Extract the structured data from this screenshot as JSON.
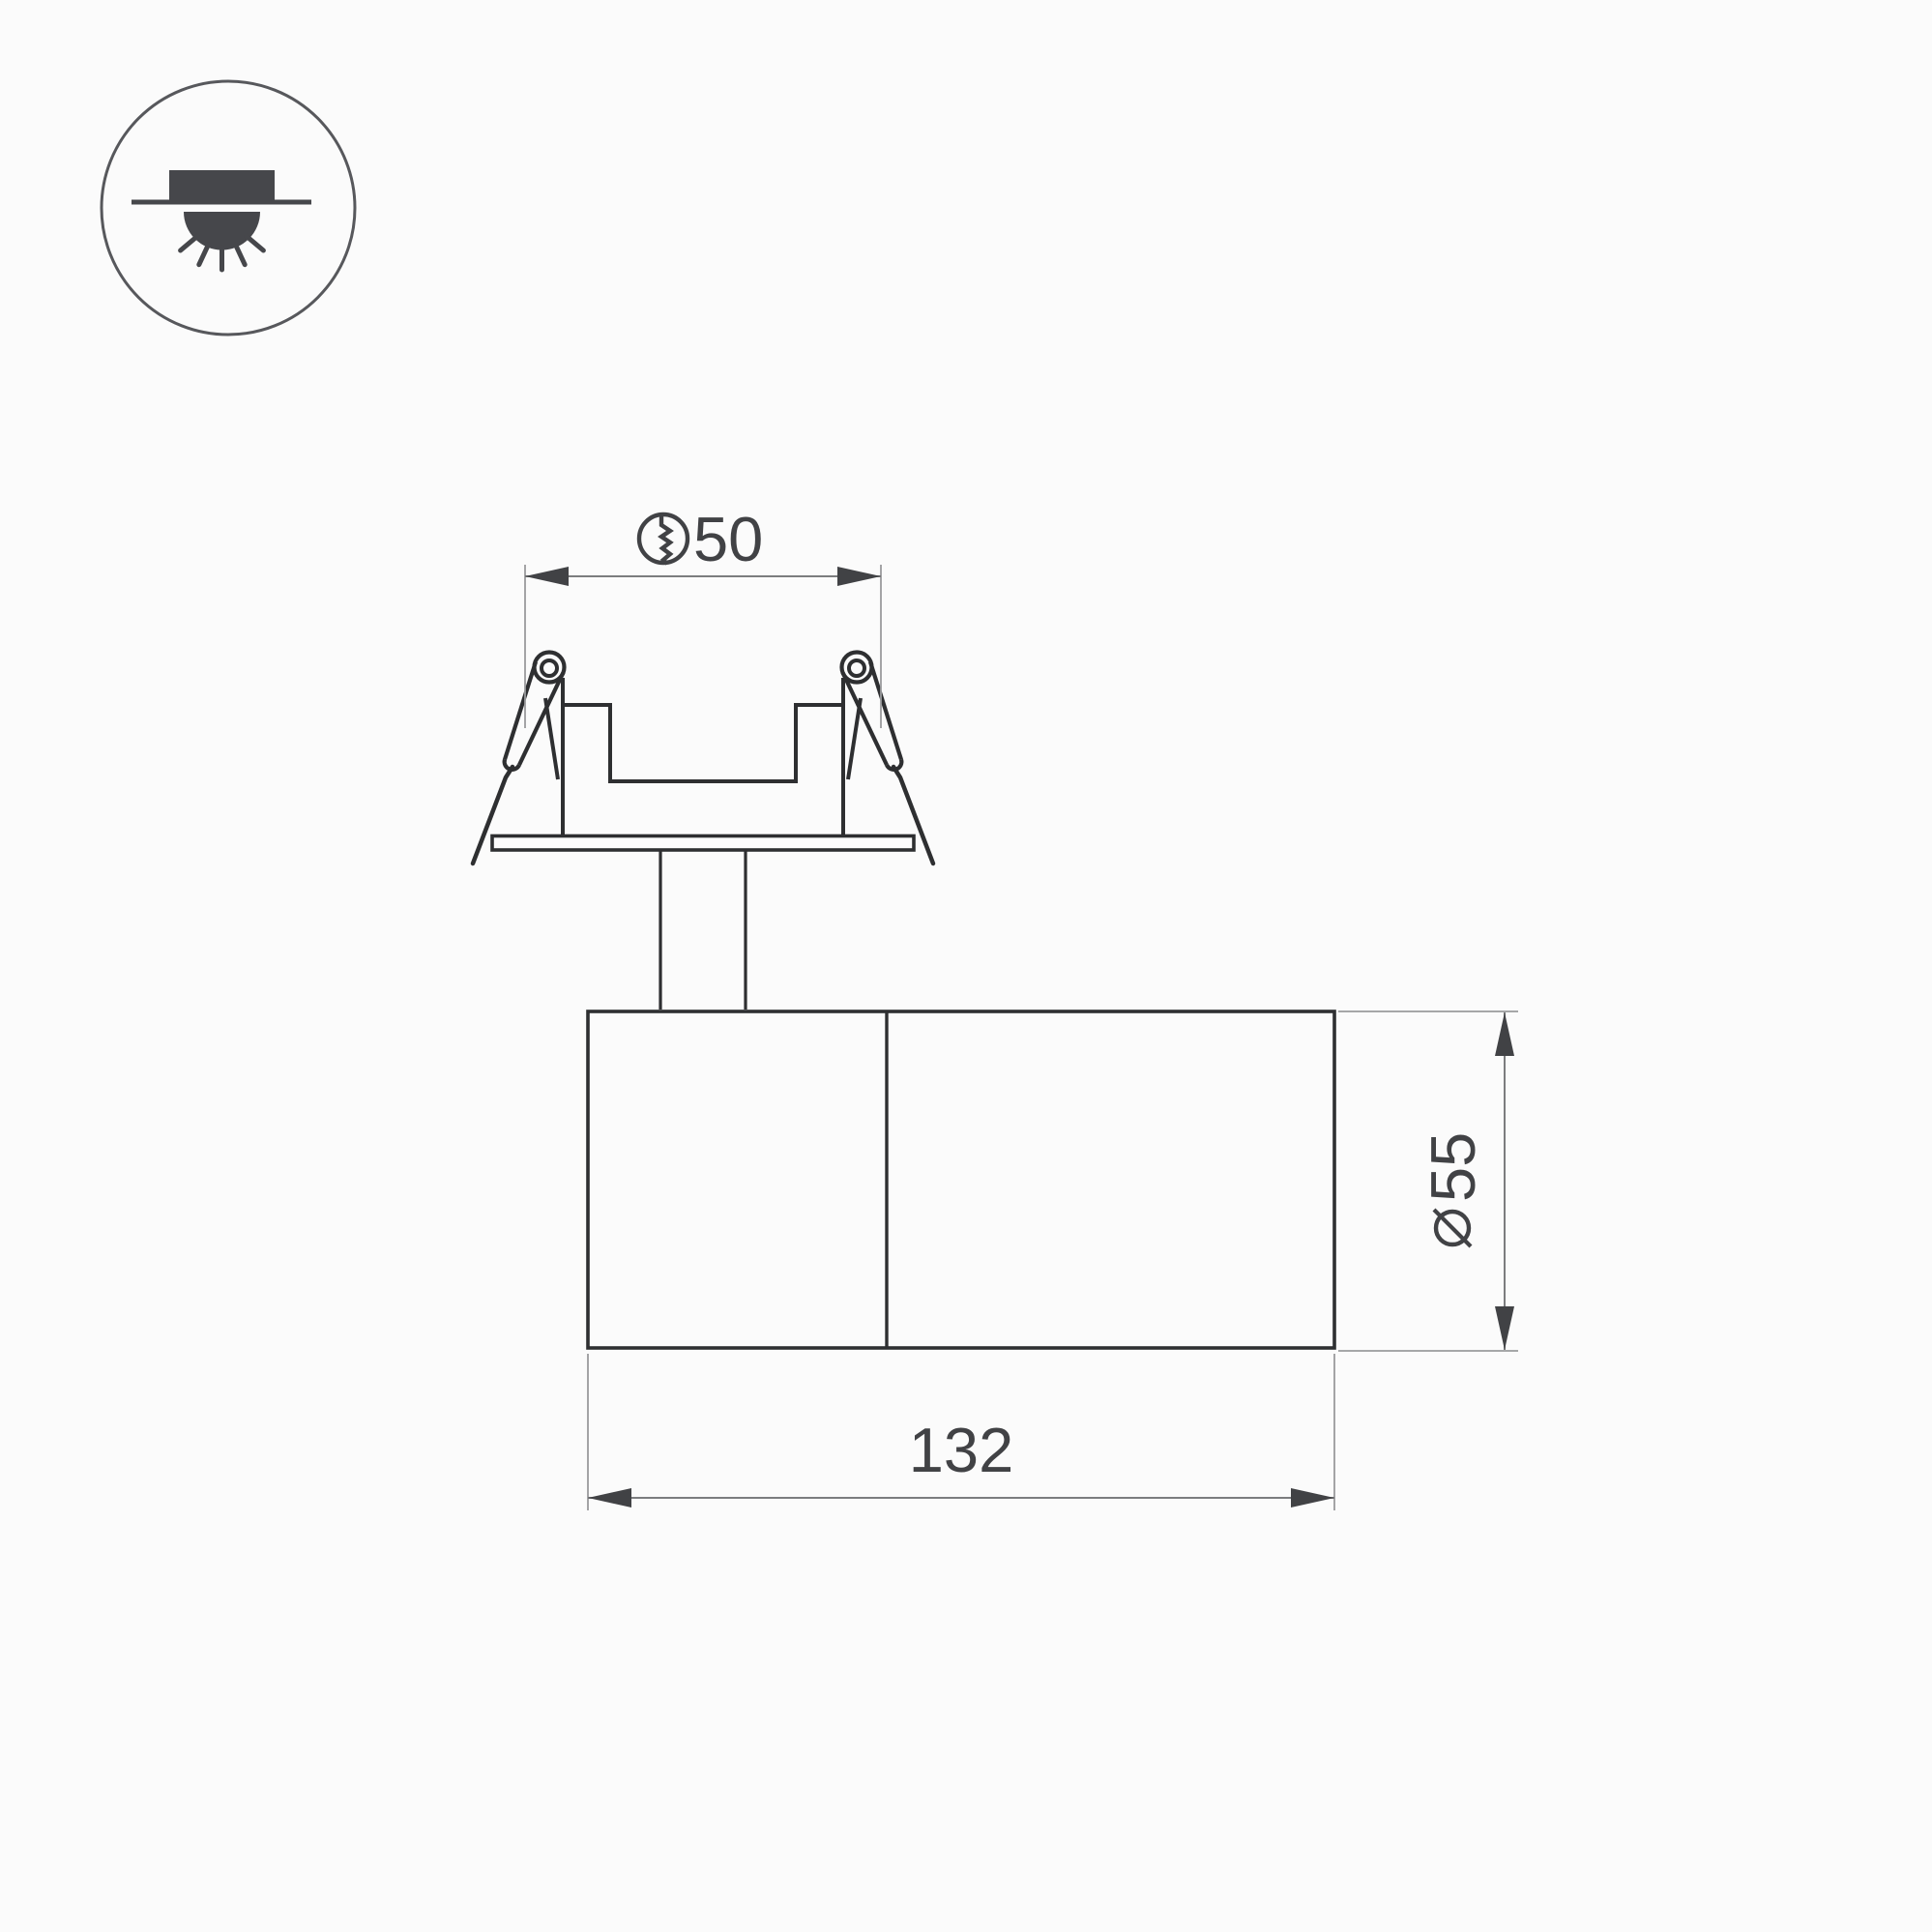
{
  "legend": {
    "icon": "recessed-downlight-icon",
    "description": "recessed ceiling downlight pictogram"
  },
  "dimensions": {
    "cutout_diameter": {
      "symbol_icon": "cutout-diameter-icon",
      "value": "50"
    },
    "body_diameter": {
      "symbol_icon": "diameter-icon",
      "value": "55"
    },
    "overall_length": {
      "value": "132"
    }
  },
  "colors": {
    "background": "#fbfbfb",
    "outline": "#2e2f31",
    "icon_fill": "#46474b",
    "dimension_line": "#7c7d7f",
    "extension_line": "#9a9b9d",
    "text_and_arrows": "#414245"
  }
}
